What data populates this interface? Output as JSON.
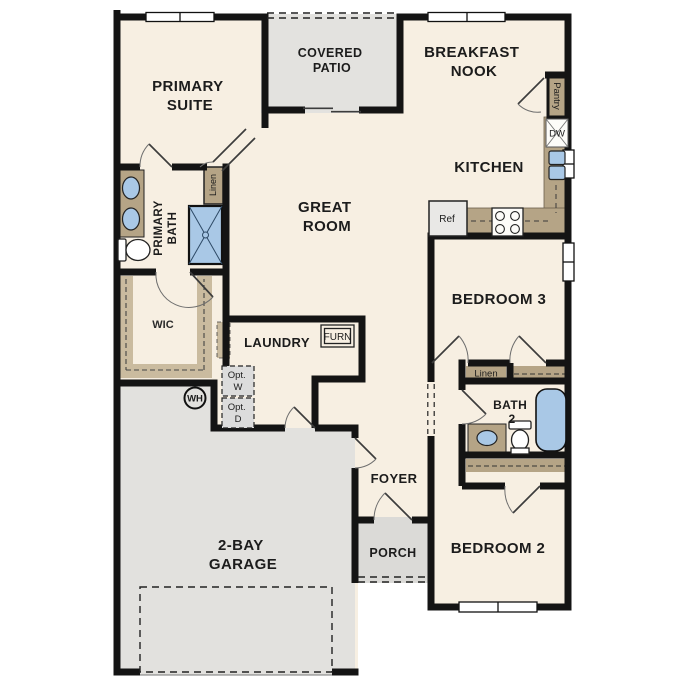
{
  "plan": {
    "type": "residential-floor-plan",
    "colors": {
      "wall": "#141414",
      "floor_cream": "#f7efe2",
      "patio_gray": "#e3e2df",
      "garage_gray": "#e2e1de",
      "porch_gray": "#dbdad7",
      "cabinet_tan": "#b5a486",
      "fixture_blue": "#a9c8e6",
      "optional_gray": "#dcdcdc"
    },
    "rooms": {
      "primary_suite": {
        "line1": "PRIMARY",
        "line2": "SUITE"
      },
      "covered_patio": {
        "line1": "COVERED",
        "line2": "PATIO"
      },
      "breakfast_nook": {
        "line1": "BREAKFAST",
        "line2": "NOOK"
      },
      "kitchen": {
        "label": "KITCHEN"
      },
      "great_room": {
        "line1": "GREAT",
        "line2": "ROOM"
      },
      "bedroom3": {
        "label": "BEDROOM 3"
      },
      "bedroom2": {
        "label": "BEDROOM 2"
      },
      "primary_bath": {
        "line1": "PRIMARY",
        "line2": "BATH"
      },
      "bath2": {
        "line1": "BATH",
        "line2": "2"
      },
      "wic": {
        "label": "WIC"
      },
      "laundry": {
        "label": "LAUNDRY"
      },
      "foyer": {
        "label": "FOYER"
      },
      "porch": {
        "label": "PORCH"
      },
      "garage": {
        "line1": "2-BAY",
        "line2": "GARAGE"
      }
    },
    "fixtures": {
      "refrigerator": "Ref",
      "dishwasher": "DW",
      "pantry": "Pantry",
      "linen_primary": "Linen",
      "linen_hall": "Linen",
      "furnace": "FURN",
      "water_heater": "WH",
      "opt_washer": {
        "line1": "Opt.",
        "line2": "W"
      },
      "opt_dryer": {
        "line1": "Opt.",
        "line2": "D"
      }
    }
  }
}
